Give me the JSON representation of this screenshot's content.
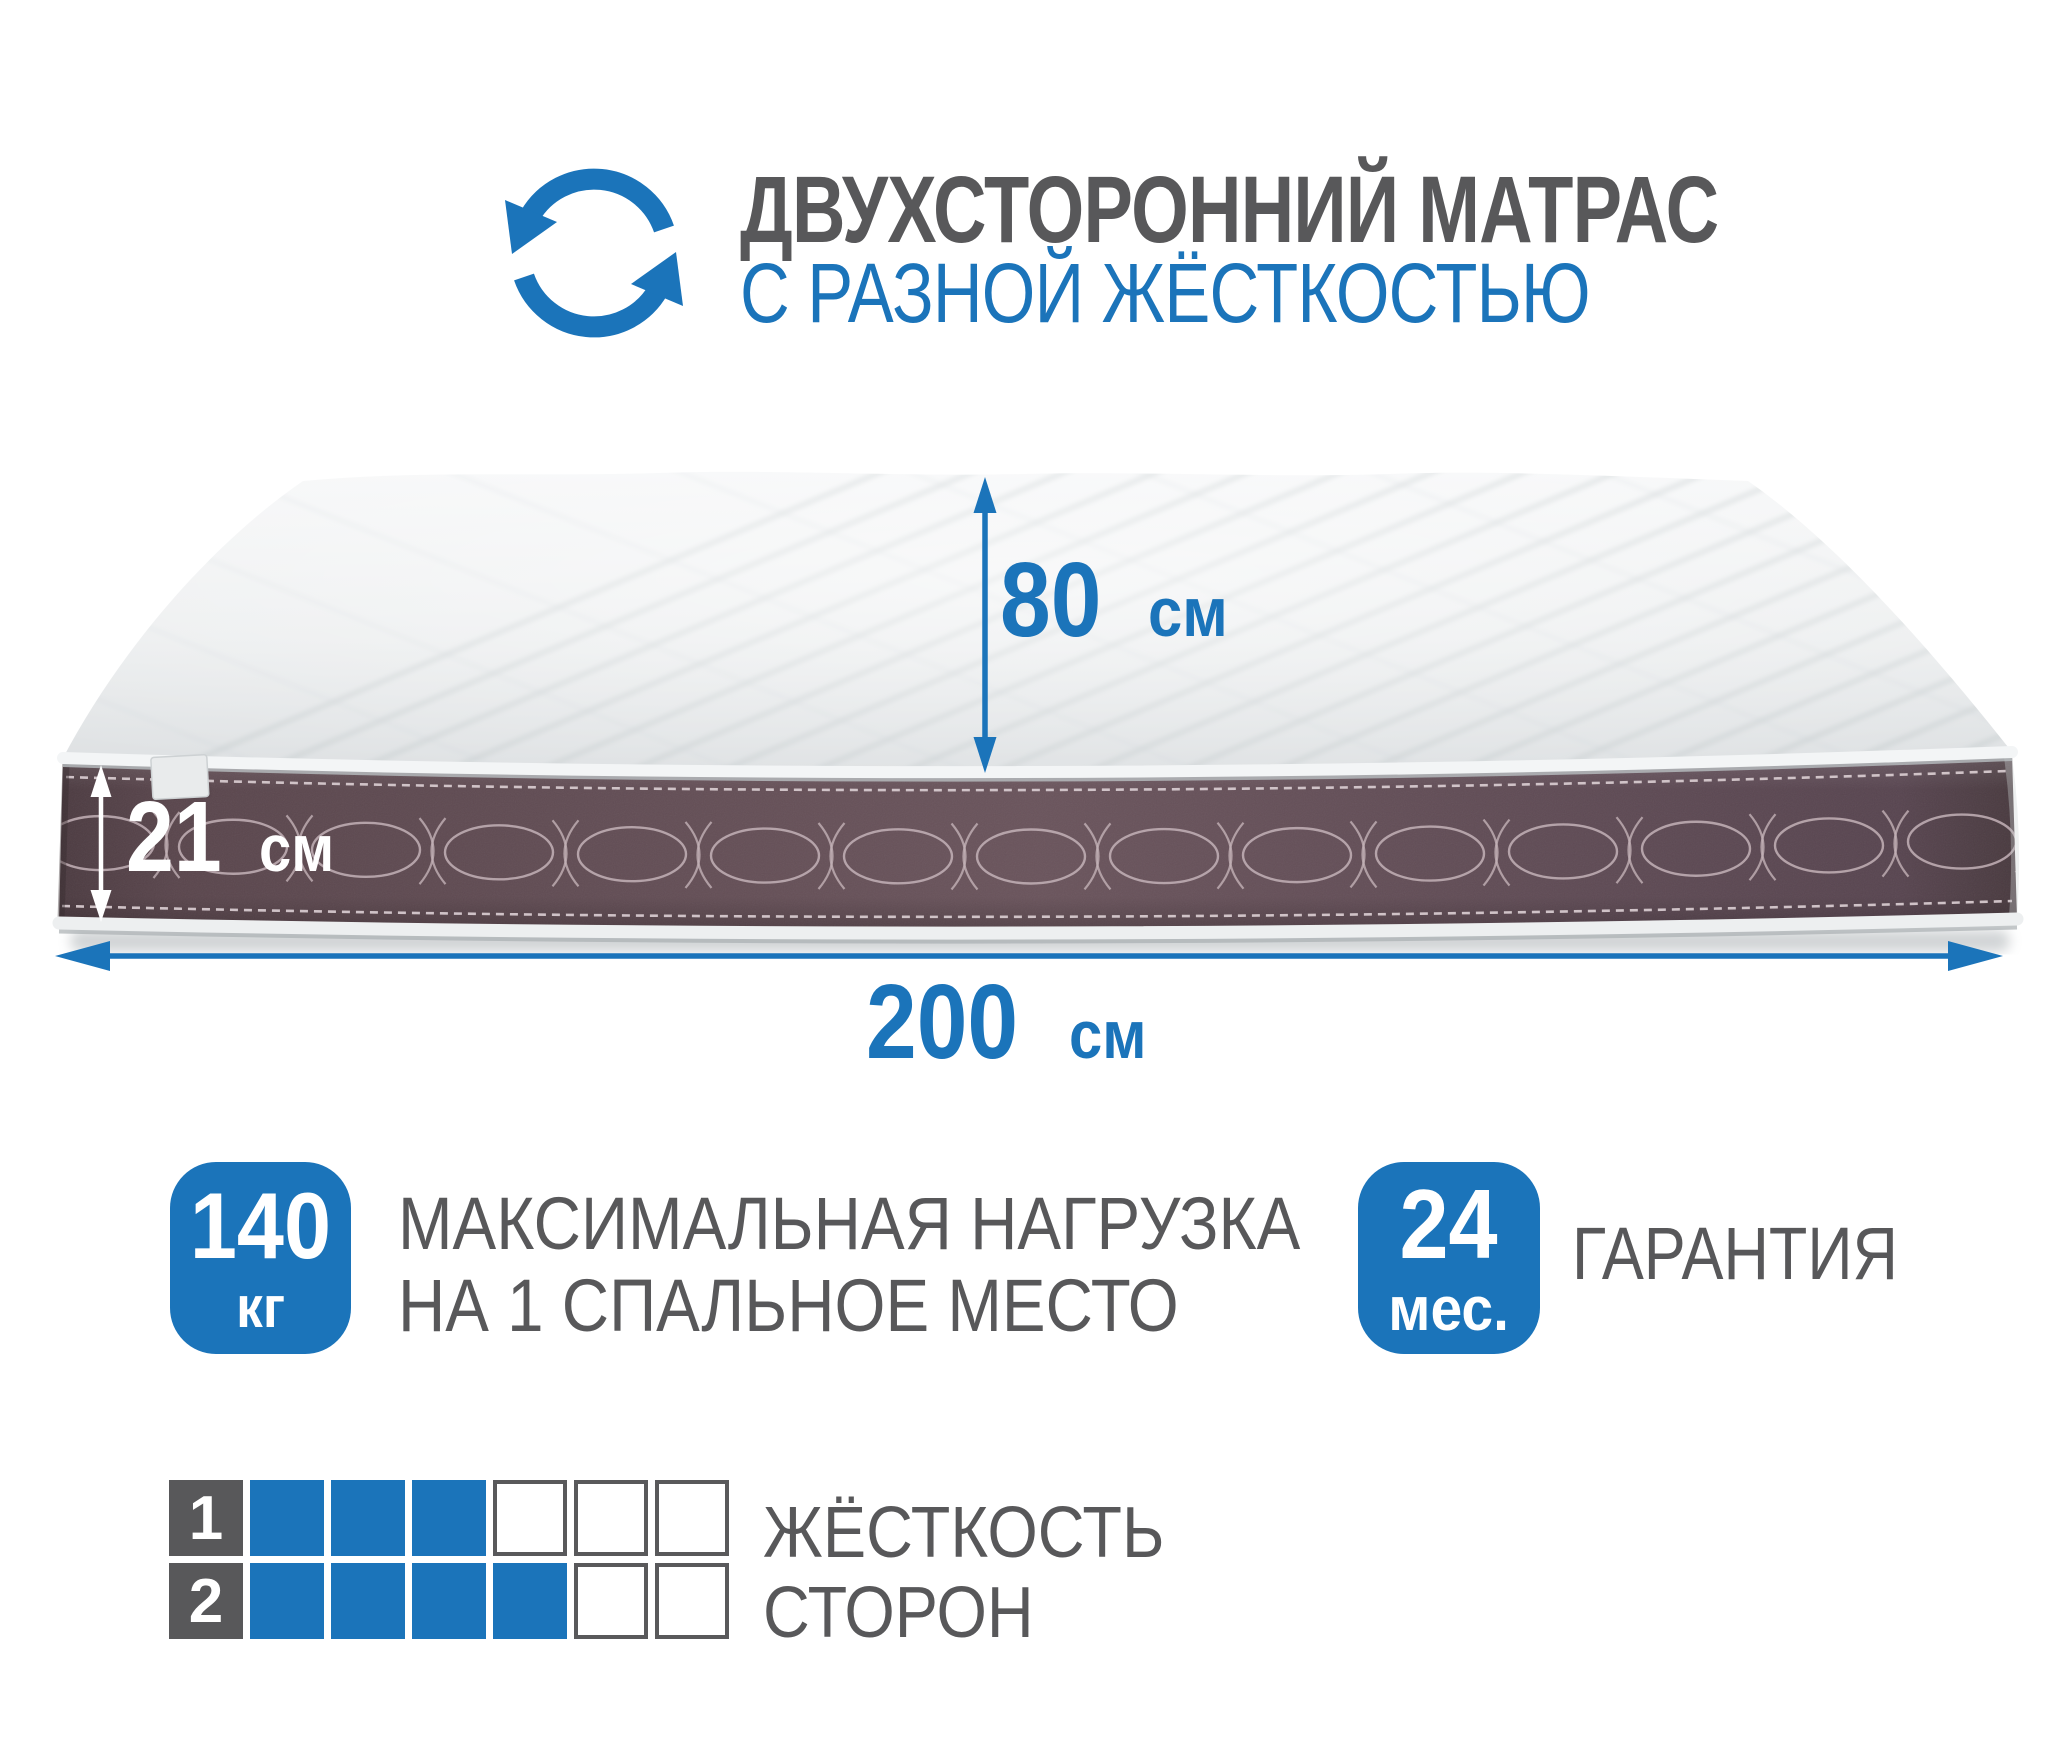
{
  "header": {
    "title": "ДВУХСТОРОННИЙ МАТРАС",
    "subtitle": "С РАЗНОЙ ЖЁСТКОСТЬЮ",
    "icon": "rotate-arrows-icon"
  },
  "dimensions": {
    "height": {
      "value": "80",
      "unit": "см"
    },
    "thickness": {
      "value": "21",
      "unit": "см"
    },
    "length": {
      "value": "200",
      "unit": "см"
    }
  },
  "features": {
    "max_load": {
      "badge_value": "140",
      "badge_unit": "кг",
      "label_line1": "МАКСИМАЛЬНАЯ НАГРУЗКА",
      "label_line2": "НА 1 СПАЛЬНОЕ МЕСТО"
    },
    "warranty": {
      "badge_value": "24",
      "badge_unit": "мес.",
      "label": "ГАРАНТИЯ"
    }
  },
  "firmness": {
    "label_line1": "ЖЁСТКОСТЬ",
    "label_line2": "СТОРОН",
    "rows": [
      {
        "label": "1",
        "filled": 3,
        "total": 6
      },
      {
        "label": "2",
        "filled": 4,
        "total": 6
      }
    ]
  },
  "colors": {
    "accent_blue": "#1b74ba",
    "text_gray": "#58585a",
    "band_plum": "#5d4a50",
    "stitch_thread": "#c3b1b7"
  }
}
